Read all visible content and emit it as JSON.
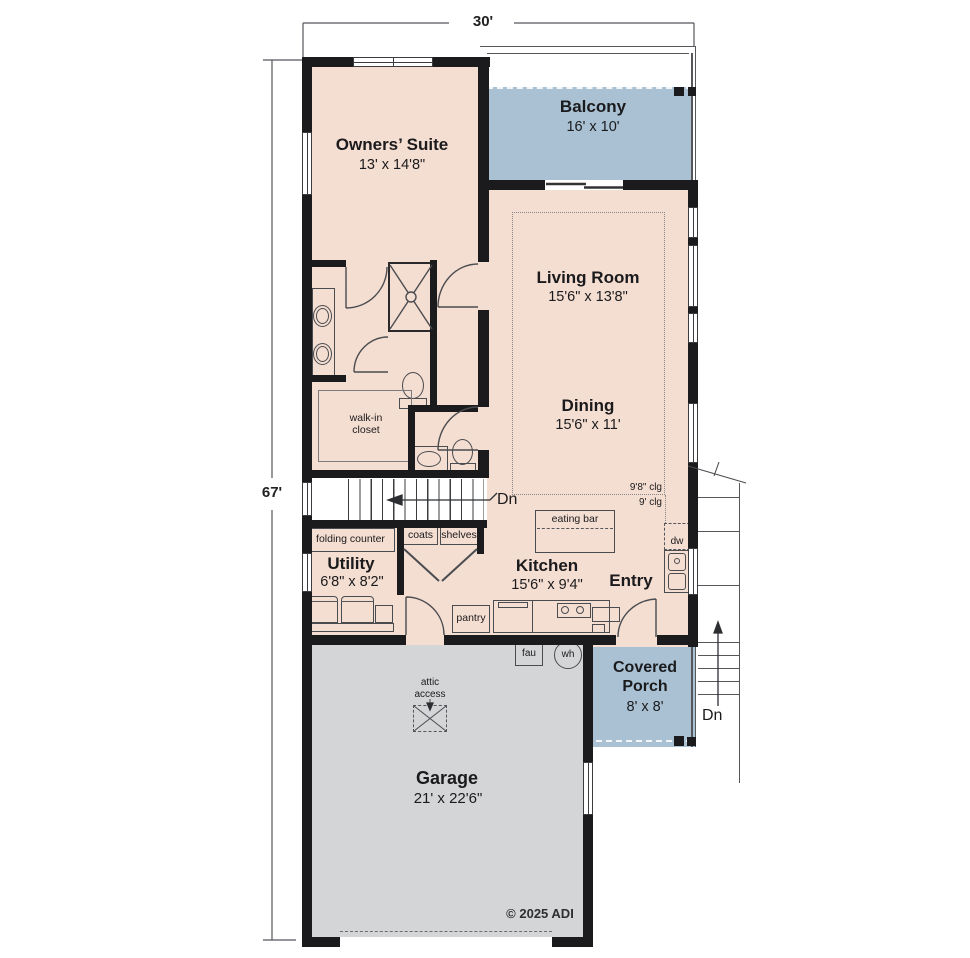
{
  "dimensions": {
    "top": "30'",
    "left": "67'"
  },
  "rooms": {
    "owners_suite": {
      "name": "Owners’ Suite",
      "size": "13' x 14'8\""
    },
    "balcony": {
      "name": "Balcony",
      "size": "16' x 10'"
    },
    "living_room": {
      "name": "Living Room",
      "size": "15'6\" x 13'8\""
    },
    "dining": {
      "name": "Dining",
      "size": "15'6\" x 11'"
    },
    "utility": {
      "name": "Utility",
      "size": "6'8\" x 8'2\""
    },
    "kitchen": {
      "name": "Kitchen",
      "size": "15'6\" x 9'4\""
    },
    "entry": {
      "name": "Entry"
    },
    "covered_porch": {
      "name": "Covered\nPorch",
      "size": "8' x 8'"
    },
    "garage": {
      "name": "Garage",
      "size": "21' x 22'6\""
    }
  },
  "labels": {
    "walk_in_closet": "walk-in\ncloset",
    "folding_counter": "folding counter",
    "coats": "coats",
    "shelves": "shelves",
    "eating_bar": "eating bar",
    "pantry": "pantry",
    "dw": "dw",
    "fau": "fau",
    "wh": "wh",
    "attic_access": "attic\naccess",
    "ceiling_high": "9'8\" clg",
    "ceiling_low": "9' clg",
    "stairs_down_interior": "Dn",
    "stairs_down_exterior": "Dn",
    "copyright": "© 2025 ADI"
  },
  "colors": {
    "wall": "#1b1b1d",
    "floor": "#f4ddd1",
    "deck": "#a9c1d3",
    "garage_floor": "#d3d5d7",
    "line": "#4a4c50"
  }
}
